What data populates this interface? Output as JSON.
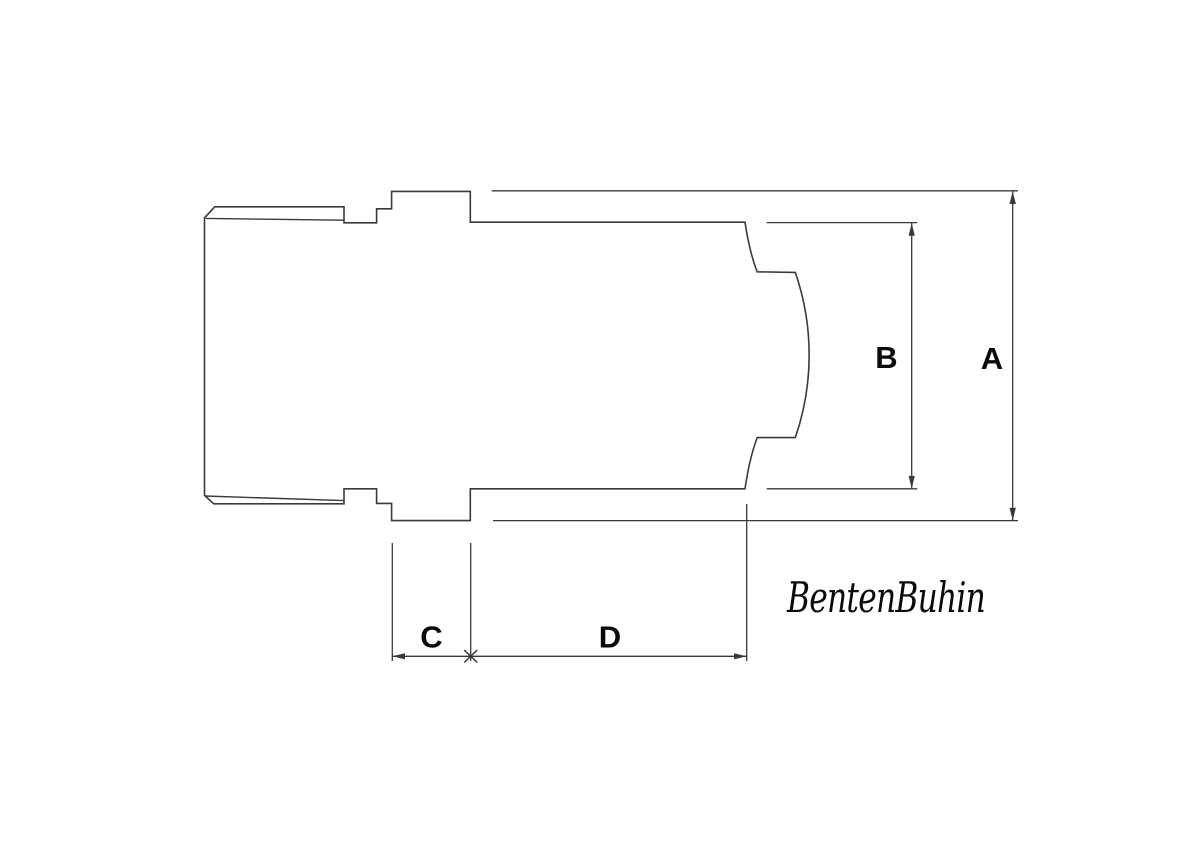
{
  "colors": {
    "background": "#ffffff",
    "line": "#3a3a3a",
    "text": "#0a0a0a"
  },
  "dimensions": {
    "a": {
      "label": "A"
    },
    "b": {
      "label": "B"
    },
    "c": {
      "label": "C"
    },
    "d": {
      "label": "D"
    }
  },
  "brand": {
    "name": "BentenBuhin"
  }
}
